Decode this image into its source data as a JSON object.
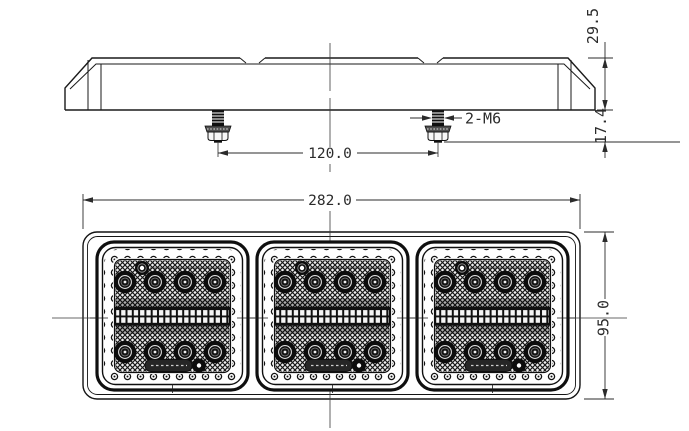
{
  "drawing_type": "technical-drawing",
  "dims": {
    "overall_width": "282.0",
    "overall_height": "95.0",
    "body_depth": "29.5",
    "stud_protrusion": "17.4",
    "stud_spacing": "120.0",
    "stud_spec": "2-M6"
  },
  "structure": {
    "lens_modules": 3,
    "leds_per_module": 8,
    "mounting_studs": 2
  },
  "colors": {
    "line": "#1a1a1a",
    "paper": "#ffffff",
    "lens_dark": "#101010"
  }
}
